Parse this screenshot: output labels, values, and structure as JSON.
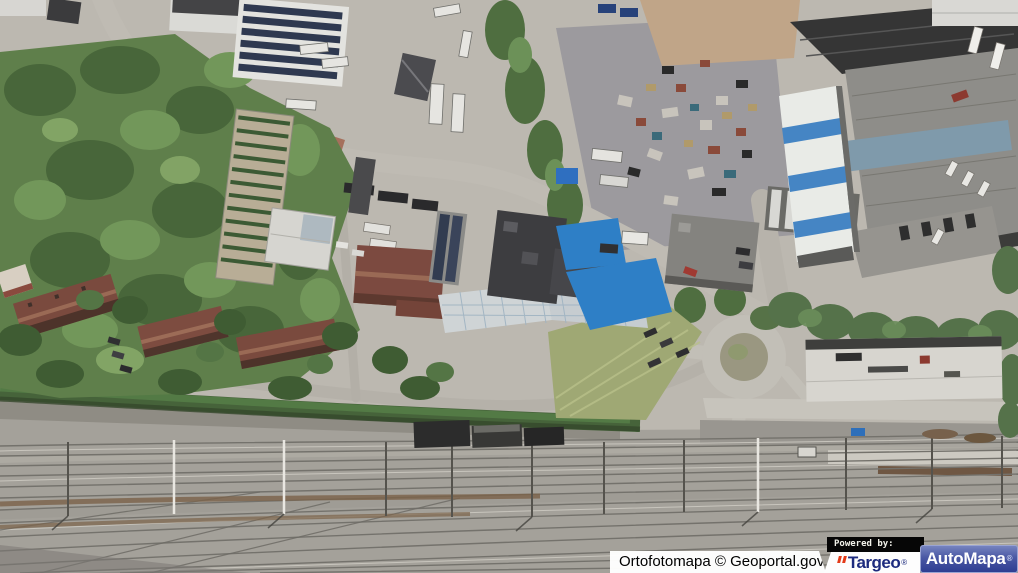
{
  "map": {
    "kind": "aerial-orthophoto",
    "visible_features": [
      "forest",
      "industrial-buildings",
      "solar-panel-roofs",
      "scrapyard",
      "blue-striped-warehouse",
      "blue-paved-yard",
      "red-roof-rowhouses",
      "garden-plant-rows",
      "roads",
      "roundabout-loop",
      "railway-yard",
      "catenary-masts",
      "level-crossing"
    ]
  },
  "attribution": {
    "imagery_credit": "Ortofotomapa © Geoportal.gov.pl",
    "powered_by_label": "Powered by:",
    "targeo": {
      "text": "Targeo",
      "registered": "®"
    },
    "automapa": {
      "text": "AutoMapa",
      "registered": "®"
    }
  },
  "colors": {
    "targeo_navy": "#1d2b7e",
    "targeo_red": "#e33a18",
    "automapa_blue": "#3a49a0",
    "credit_bar_bg": "#ffffff",
    "credit_bar_text": "#000000",
    "powered_bg": "#060606",
    "powered_text": "#f2f2ea"
  }
}
